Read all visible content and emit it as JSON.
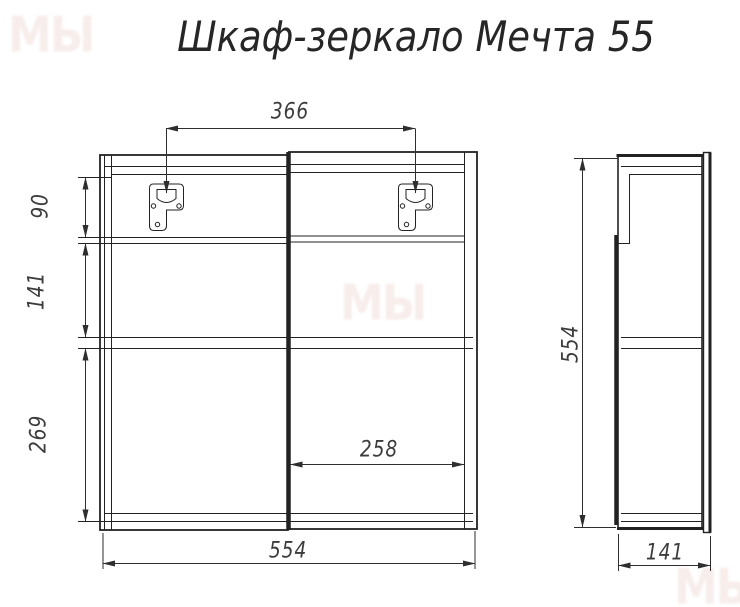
{
  "title": "Шкаф-зеркало Мечта 55",
  "watermark": "МЫ",
  "front_view": {
    "hanger_spacing": "366",
    "upper_section_height": "90",
    "middle_section_height": "141",
    "lower_section_height": "269",
    "right_door_width": "258",
    "overall_width": "554"
  },
  "side_view": {
    "overall_height": "554",
    "overall_depth": "141"
  },
  "colors": {
    "line": "#222222",
    "dim_line": "#2e2e2e",
    "dim_text": "#3c3c3c",
    "background": "#ffffff"
  }
}
